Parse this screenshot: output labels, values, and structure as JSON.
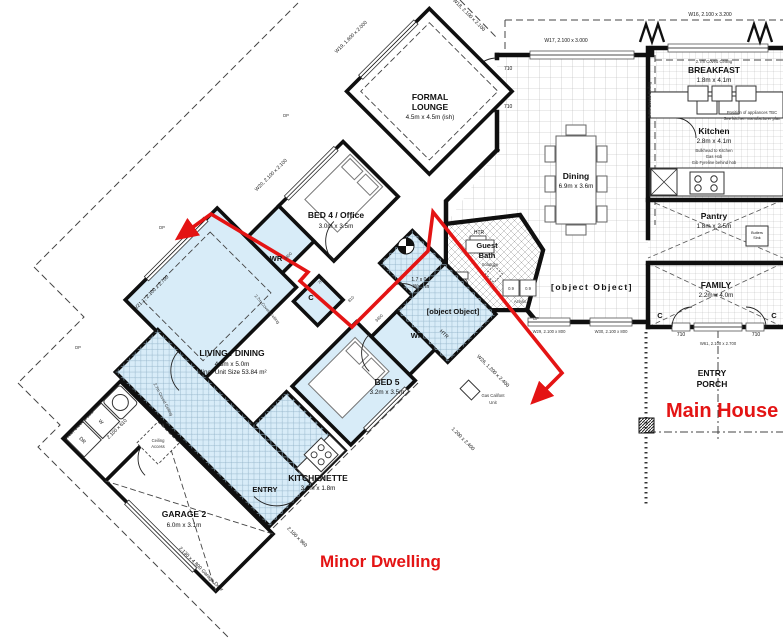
{
  "titles": {
    "minor_dwelling": "Minor Dwelling",
    "main_house": "Main House"
  },
  "rooms": {
    "living": {
      "name": "LIVING / DINING",
      "size": "4.3m x 5.0m",
      "note": "Minor Unit Size 53.84 m²"
    },
    "bed4": {
      "name": "BED 4 / Office",
      "size": "3.0m x 3.5m"
    },
    "bed5": {
      "name": "BED 5",
      "size": "3.2m x 3.5m"
    },
    "lounge": {
      "name1": "FORMAL",
      "name2": "LOUNGE",
      "size": "4.5m x 4.5m (ish)"
    },
    "kitchenette": {
      "name": "KITCHENETTE",
      "size": "3.2m x 1.8m"
    },
    "entry": {
      "name": "ENTRY"
    },
    "garage": {
      "name": "GARAGE 2",
      "size": "6.0m x 3.1m"
    },
    "dining": {
      "name": "Dining",
      "size": "6.9m x 3.6m"
    },
    "gallery": {
      "name": "GALLERY"
    },
    "breakfast": {
      "name": "BREAKFAST",
      "size": "1.8m x 4.1m",
      "note": "2.7m Coved Ceiling"
    },
    "kitchen": {
      "name": "Kitchen",
      "size": "2.8m x 4.1m",
      "note1": "Bulkhead to Kitchen",
      "note2": "Gas Hob",
      "note3": "Gib Fyreline behind hob"
    },
    "pantry": {
      "name": "Pantry",
      "size": "1.8m x 2.5m"
    },
    "family": {
      "name": "FAMILY",
      "size": "2.2m x 4.0m"
    },
    "porch": {
      "name1": "ENTRY",
      "name2": "PORCH"
    },
    "guest_bath": {
      "name1": "Guest",
      "name2": "Bath"
    },
    "ens4": {
      "name": "ENS. 4"
    },
    "walkin": {
      "l1": "1.7 x 0.9",
      "l2": "Walk In"
    },
    "wr": "WR",
    "c": "C"
  },
  "annotations": {
    "coved": "2.7m Coved Ceiling",
    "solatube": "Solatube",
    "htr": "HTR",
    "acrylic": "Acrylic",
    "d09": "0.9",
    "ceiling1": "Ceiling",
    "ceiling2": "Access",
    "gas_califont1": "Gas Califont",
    "gas_califont2": "Unit",
    "butlers1": "Butlers",
    "butlers2": "Sink",
    "appliance1": "Position of appliances TBC",
    "appliance2": "See kitchen manufacturer plan",
    "dr": "DR",
    "w": "W",
    "dp": "DP",
    "dim3400": "3400"
  },
  "openings": {
    "d710": "710",
    "d810": "810",
    "d760": "760",
    "w16": "W16, 2.100 x 3.200",
    "w17": "W17, 2.100 x 3.000",
    "w18": "W18, 2.100 x 2.100",
    "w19": "W19, 1.600 x 2.000",
    "w20": "W20, 2.100 x 2.100",
    "w21": "W21.1, 2.100 x 2.700",
    "w22": "W22, 1.200 x 900",
    "w22b": "2.100 x 610",
    "w25": "2.100 x 960",
    "w26": "W26, 1.200 x 2.400",
    "w27": "1.200 x 2.400",
    "w29": "W29, 2.100 x 800",
    "w30": "W30, 2.100 x 800",
    "w61": "W61, 2.100 x 2.700",
    "garage_door": "2.130 x 4.800 Garage Door"
  }
}
